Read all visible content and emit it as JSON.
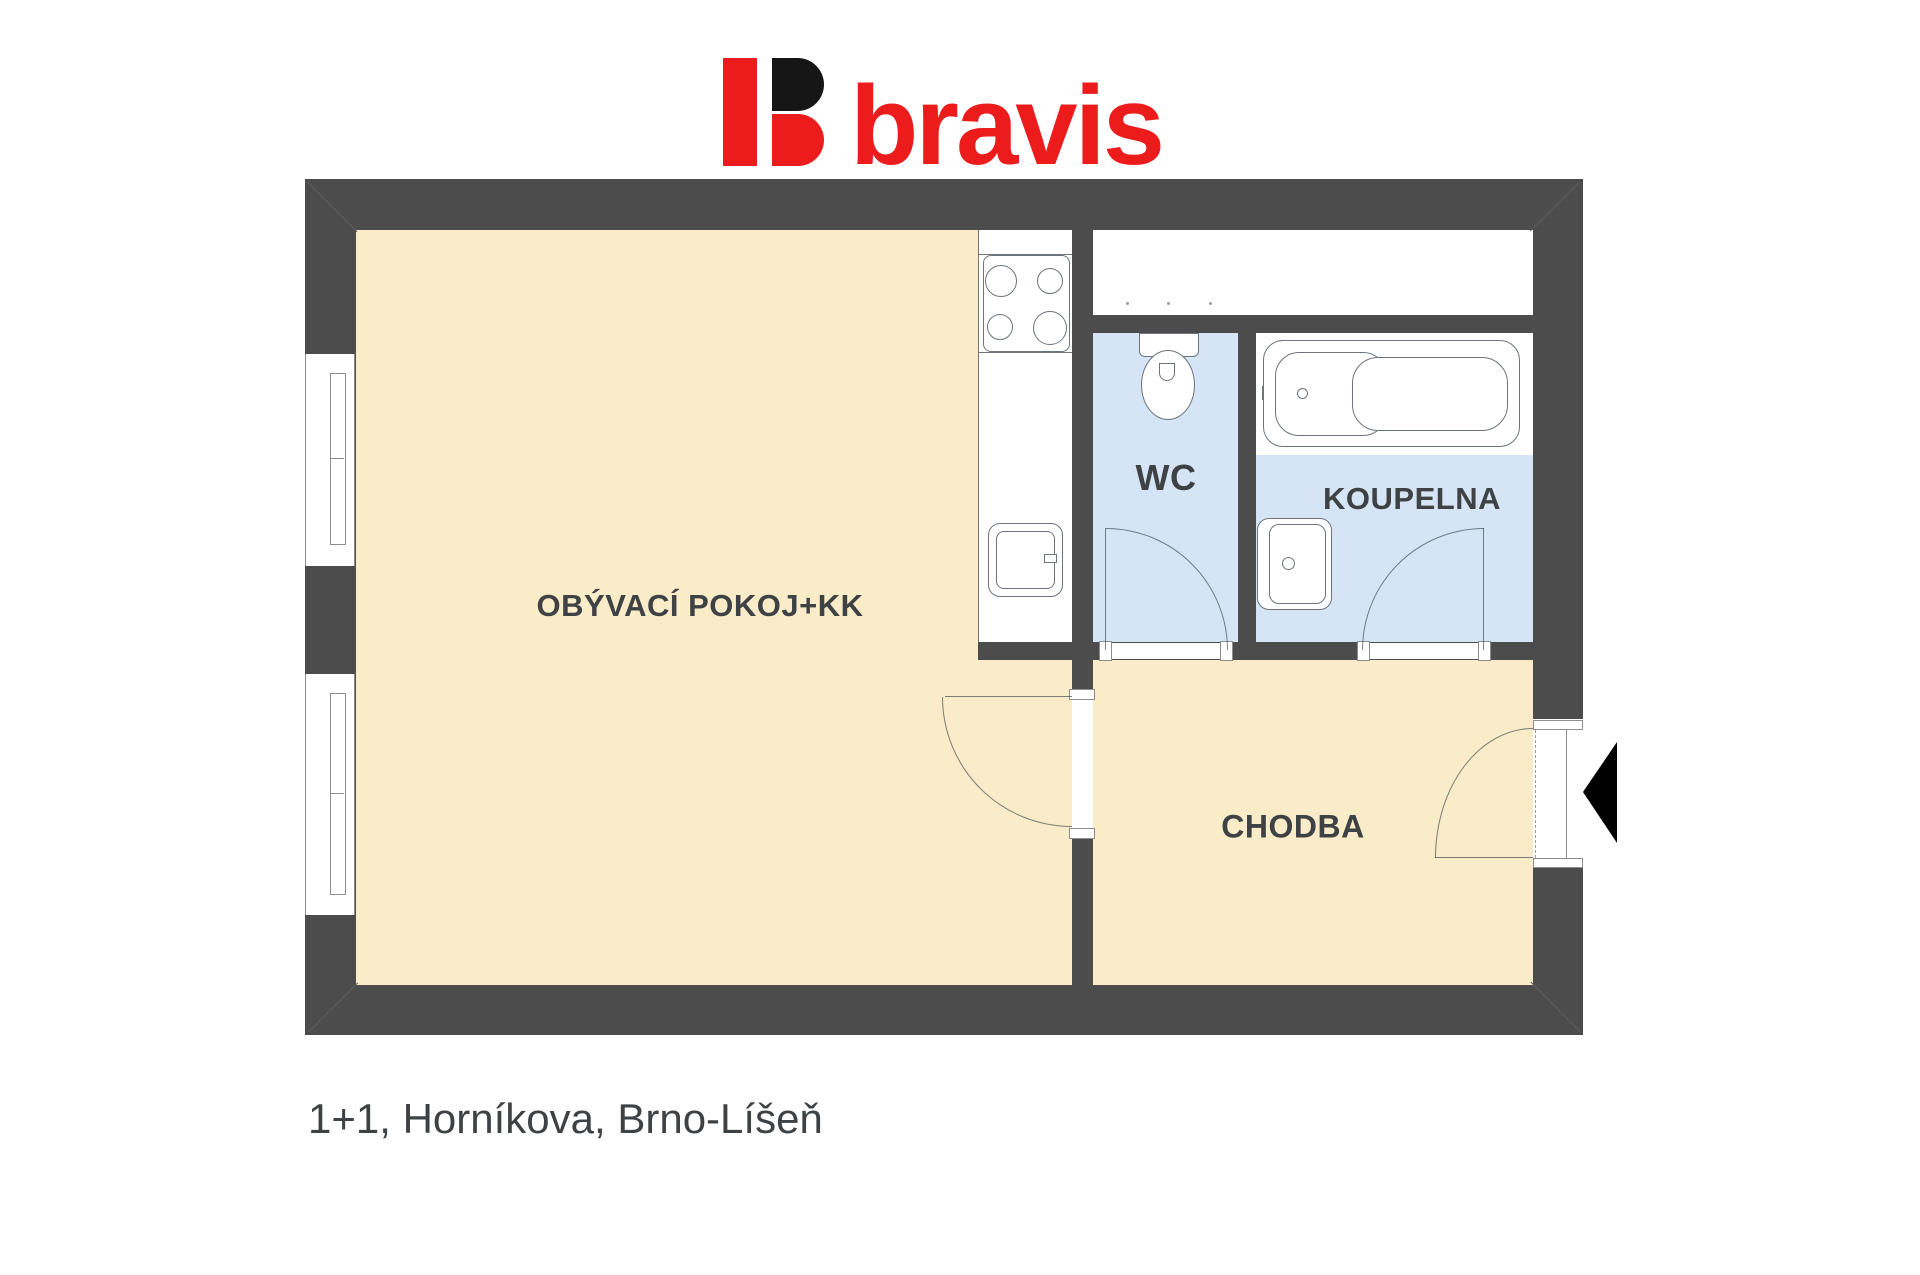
{
  "brand": {
    "name": "bravis",
    "red": "#ed1c1c",
    "black": "#161616"
  },
  "plan": {
    "rooms": {
      "living": {
        "label": "OBÝVACÍ POKOJ+KK"
      },
      "wc": {
        "label": "WC"
      },
      "bathroom": {
        "label": "KOUPELNA"
      },
      "hallway": {
        "label": "CHODBA"
      }
    },
    "colors": {
      "wall": "#4c4c4c",
      "floor_warm": "#faecc8",
      "floor_wet": "#d5e5f6",
      "fixture_outline": "#6d747b",
      "label_text": "#3f4245"
    },
    "fixtures": {
      "kitchen": [
        "stove",
        "kitchen-sink",
        "kitchen-counter"
      ],
      "wc": [
        "toilet"
      ],
      "bathroom": [
        "bathtub",
        "washbasin"
      ]
    }
  },
  "caption": {
    "text": "1+1, Horníkova, Brno-Líšeň"
  }
}
